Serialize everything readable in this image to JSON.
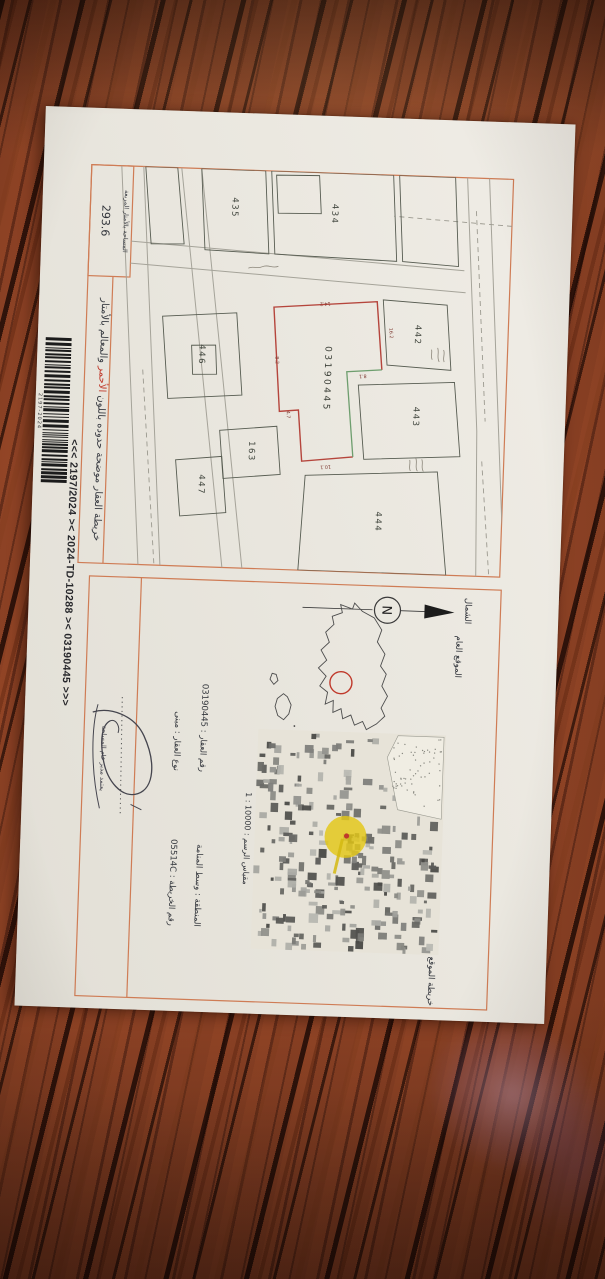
{
  "map_panel": {
    "title_prefix": "خريطة العقار موضحة حدوده باللون",
    "title_red": "الأحمر",
    "title_suffix": "والمعالم بالأمتار",
    "area_box_label": "المساحة بالأمتار المربعة",
    "area_box_value": "293.6",
    "subject_parcel_number": "03190445",
    "parcel_labels": [
      "434",
      "435",
      "442",
      "443",
      "444",
      "446",
      "447",
      "163"
    ],
    "dimension_labels": [
      "16.2",
      "8.1",
      "10.1",
      "4.7",
      "8.2",
      "14.2"
    ]
  },
  "location_panel": {
    "north_label": "الشمال",
    "north_letter": "N",
    "general_location_label": "الموقع العام",
    "site_map_label": "خريطة الموقع",
    "fields": [
      {
        "label": "المنطقة",
        "value": "وسط المنامة"
      },
      {
        "label": "رقم العقار",
        "value": "03190445"
      },
      {
        "label": "رقم الخريطة",
        "value": "05514C"
      },
      {
        "label": "نوع العقار",
        "value": "مبنى"
      }
    ],
    "scale_label": "مقياس الرسم",
    "scale_value": "1 : 10000",
    "approval_text": "يعتمد مدير عام المساحة"
  },
  "footer": {
    "code_line": "<<<  2197/2024  ><  2024-TD-10288  ><  03190445  >>>",
    "barcode_number": "2197-2024"
  }
}
